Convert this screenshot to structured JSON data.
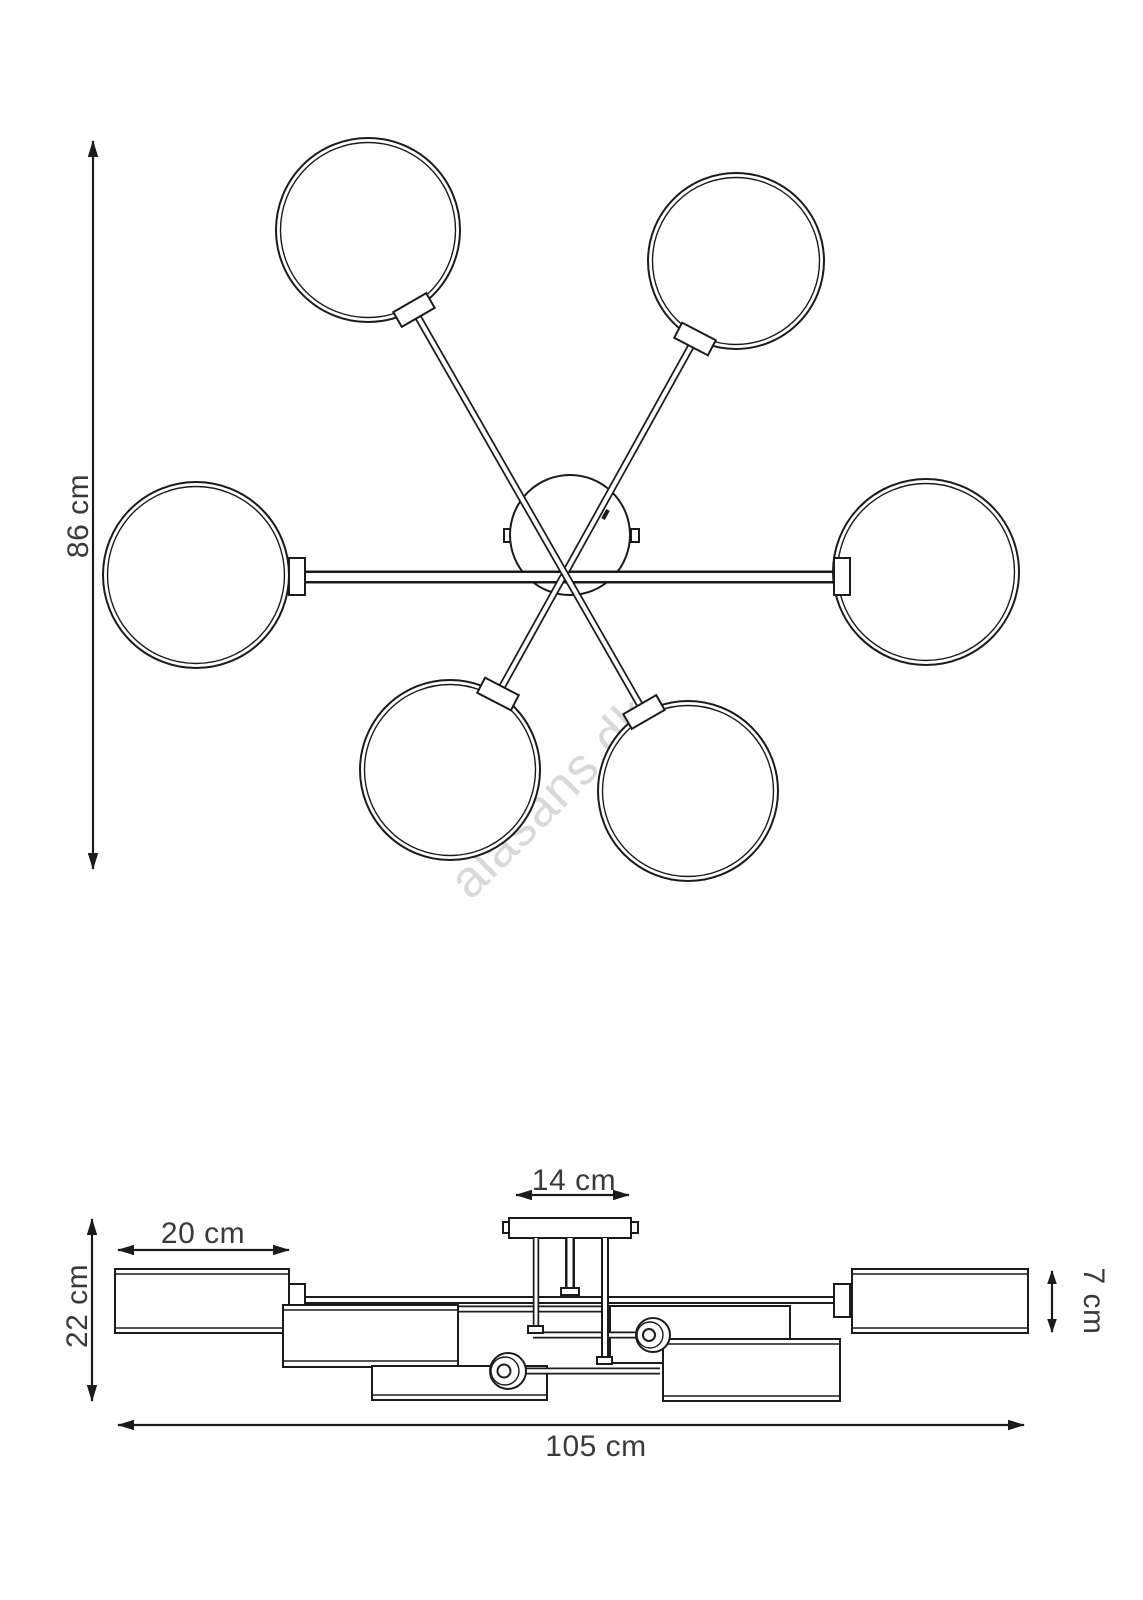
{
  "background": "#ffffff",
  "colors": {
    "line": "#1b1b1b",
    "dimension_text": "#3a3a3a",
    "watermark": "#d9d9d9"
  },
  "watermark": {
    "text": "alasans.dk"
  },
  "top_view": {
    "globe_count": 6,
    "dimensions": {
      "height": {
        "label": "86 cm",
        "value": 86,
        "unit": "cm"
      }
    }
  },
  "side_view": {
    "dimensions": {
      "canopy_width": {
        "label": "14 cm",
        "value": 14,
        "unit": "cm"
      },
      "shade_width": {
        "label": "20 cm",
        "value": 20,
        "unit": "cm"
      },
      "total_height": {
        "label": "22 cm",
        "value": 22,
        "unit": "cm"
      },
      "shade_height": {
        "label": "7 cm",
        "value": 7,
        "unit": "cm"
      },
      "total_width": {
        "label": "105 cm",
        "value": 105,
        "unit": "cm"
      }
    }
  }
}
